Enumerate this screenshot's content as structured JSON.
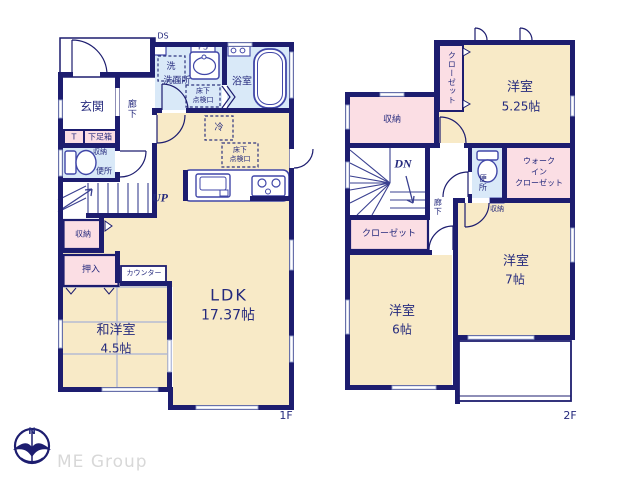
{
  "colors": {
    "wall_navy": "#1d1d6f",
    "room_cream": "#f8eac7",
    "closet_pink": "#fbdee4",
    "wet_area_blue": "#d9e9f8",
    "fixture_blue": "#4147a8",
    "logo_gray": "#d8d8d8"
  },
  "floor1": {
    "floor_label": "1F",
    "labels": {
      "ds": "DS",
      "ps": "PS",
      "washer": "洗",
      "washroom": "洗面所",
      "hatch_a1": "床下",
      "hatch_a2": "点検口",
      "bathroom": "浴室",
      "entrance": "玄関",
      "hallway": "廊下",
      "t_box": "T",
      "shoe_box": "下足箱",
      "toilet_storage": "収納",
      "toilet": "便所",
      "up": "UP",
      "fridge": "冷",
      "hatch_b1": "床下",
      "hatch_b2": "点検口",
      "storage": "収納",
      "futon_closet": "押入",
      "counter": "カウンター",
      "jp_room_name": "和洋室",
      "jp_room_size": "4.5帖",
      "ldk_name": "LDK",
      "ldk_size": "17.37帖"
    }
  },
  "floor2": {
    "floor_label": "2F",
    "labels": {
      "closet_top": "クローゼット",
      "room525_name": "洋室",
      "room525_size": "5.25帖",
      "storage_big": "収納",
      "dn": "DN",
      "hallway": "廊下",
      "toilet": "便所",
      "wic_line1": "ウォーク",
      "wic_line2": "イン",
      "wic_line3": "クローゼット",
      "storage_small": "収納",
      "room7_name": "洋室",
      "room7_size": "7帖",
      "closet_bottom": "クローゼット",
      "room6_name": "洋室",
      "room6_size": "6帖"
    }
  },
  "logo": {
    "compass_n": "N",
    "company": "ME Group"
  }
}
